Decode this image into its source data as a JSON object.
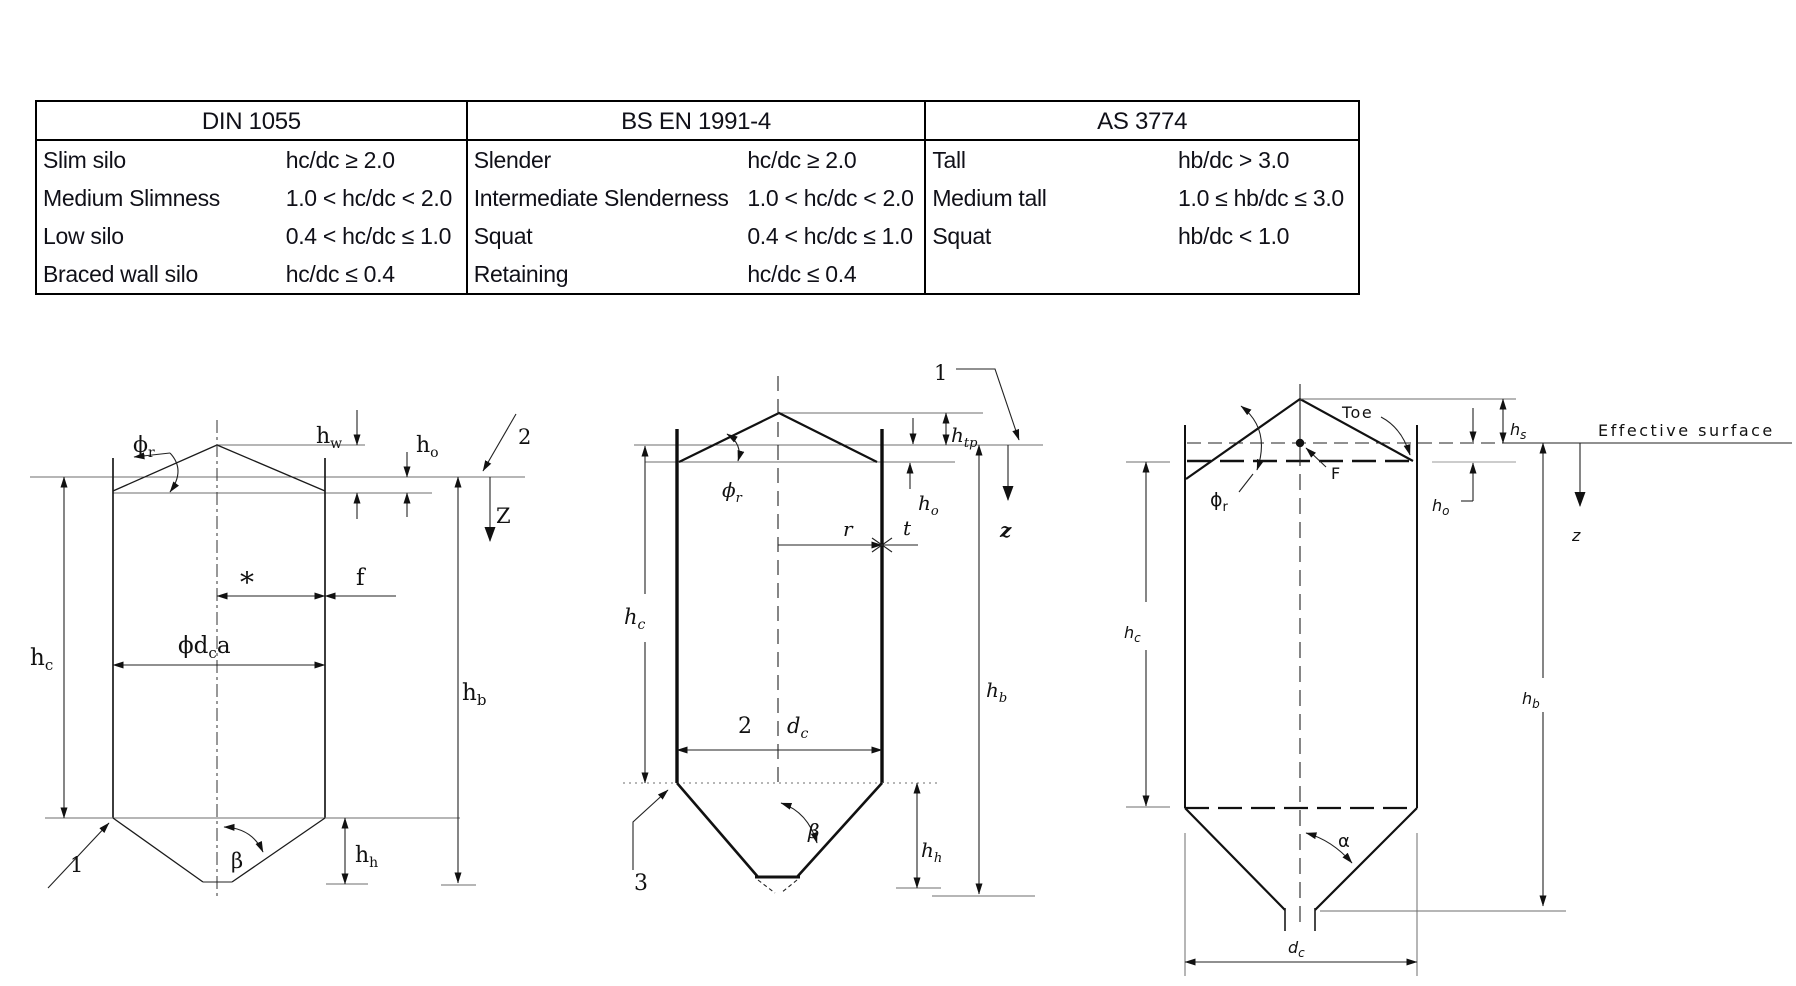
{
  "table": {
    "groups": [
      {
        "header": "DIN 1055",
        "rows": [
          {
            "name": "Slim silo",
            "value": "hc/dc ≥ 2.0"
          },
          {
            "name": "Medium Slimness",
            "value": "1.0 < hc/dc < 2.0"
          },
          {
            "name": "Low silo",
            "value": "0.4 < hc/dc ≤ 1.0"
          },
          {
            "name": "Braced wall silo",
            "value": "hc/dc ≤ 0.4"
          }
        ]
      },
      {
        "header": "BS EN 1991-4",
        "rows": [
          {
            "name": "Slender",
            "value": "hc/dc ≥ 2.0"
          },
          {
            "name": "Intermediate Slenderness",
            "value": "1.0 < hc/dc < 2.0"
          },
          {
            "name": "Squat",
            "value": "0.4 < hc/dc ≤ 1.0"
          },
          {
            "name": "Retaining",
            "value": "hc/dc ≤ 0.4"
          }
        ]
      },
      {
        "header": "AS 3774",
        "rows": [
          {
            "name": "Tall",
            "value": "hb/dc > 3.0"
          },
          {
            "name": "Medium tall",
            "value": "1.0 ≤ hb/dc ≤ 3.0"
          },
          {
            "name": "Squat",
            "value": "hb/dc < 1.0"
          },
          {
            "name": "",
            "value": ""
          }
        ]
      }
    ]
  },
  "diagrams": {
    "din": {
      "labels": {
        "phi_r": {
          "m": "ϕ",
          "s": "r"
        },
        "h_w": {
          "m": "h",
          "s": "w"
        },
        "h_o": {
          "m": "h",
          "s": "o"
        },
        "callout_2": "2",
        "z": "Z",
        "h_c": {
          "m": "h",
          "s": "c"
        },
        "h_b": {
          "m": "h",
          "s": "b"
        },
        "star": "*",
        "f": "f",
        "phi_dc_a": {
          "pre": "ϕd",
          "s": "c",
          "post": "a"
        },
        "beta": "β",
        "callout_1": "1",
        "h_h": {
          "m": "h",
          "s": "h"
        }
      }
    },
    "bs_en": {
      "labels": {
        "callout_1": "1",
        "h_tp": {
          "m": "h",
          "s": "tp"
        },
        "h_o": {
          "m": "h",
          "s": "o"
        },
        "phi_r": {
          "m": "ϕ",
          "s": "r"
        },
        "h_c": {
          "m": "h",
          "s": "c"
        },
        "r": "r",
        "t": "t",
        "two": "2",
        "d_c": {
          "m": "d",
          "s": "c"
        },
        "z": "z",
        "h_b": {
          "m": "h",
          "s": "b"
        },
        "beta": "β",
        "callout_3": "3",
        "h_h": {
          "m": "h",
          "s": "h"
        }
      }
    },
    "as": {
      "labels": {
        "toe": "Toe",
        "f_point": "F",
        "phi_r": {
          "m": "ϕ",
          "s": "r"
        },
        "h_s": {
          "m": "h",
          "s": "s"
        },
        "h_o": {
          "m": "h",
          "s": "o"
        },
        "effective_surface": "Effective surface",
        "z": "z",
        "h_c": {
          "m": "h",
          "s": "c"
        },
        "h_b": {
          "m": "h",
          "s": "b"
        },
        "alpha": "α",
        "d_c": {
          "m": "d",
          "s": "c"
        }
      }
    }
  },
  "colors": {
    "line": "#1b1b1b",
    "reference_line": "#6e6e6e",
    "text": "#101018",
    "table_border": "#000000",
    "background": "#ffffff"
  }
}
